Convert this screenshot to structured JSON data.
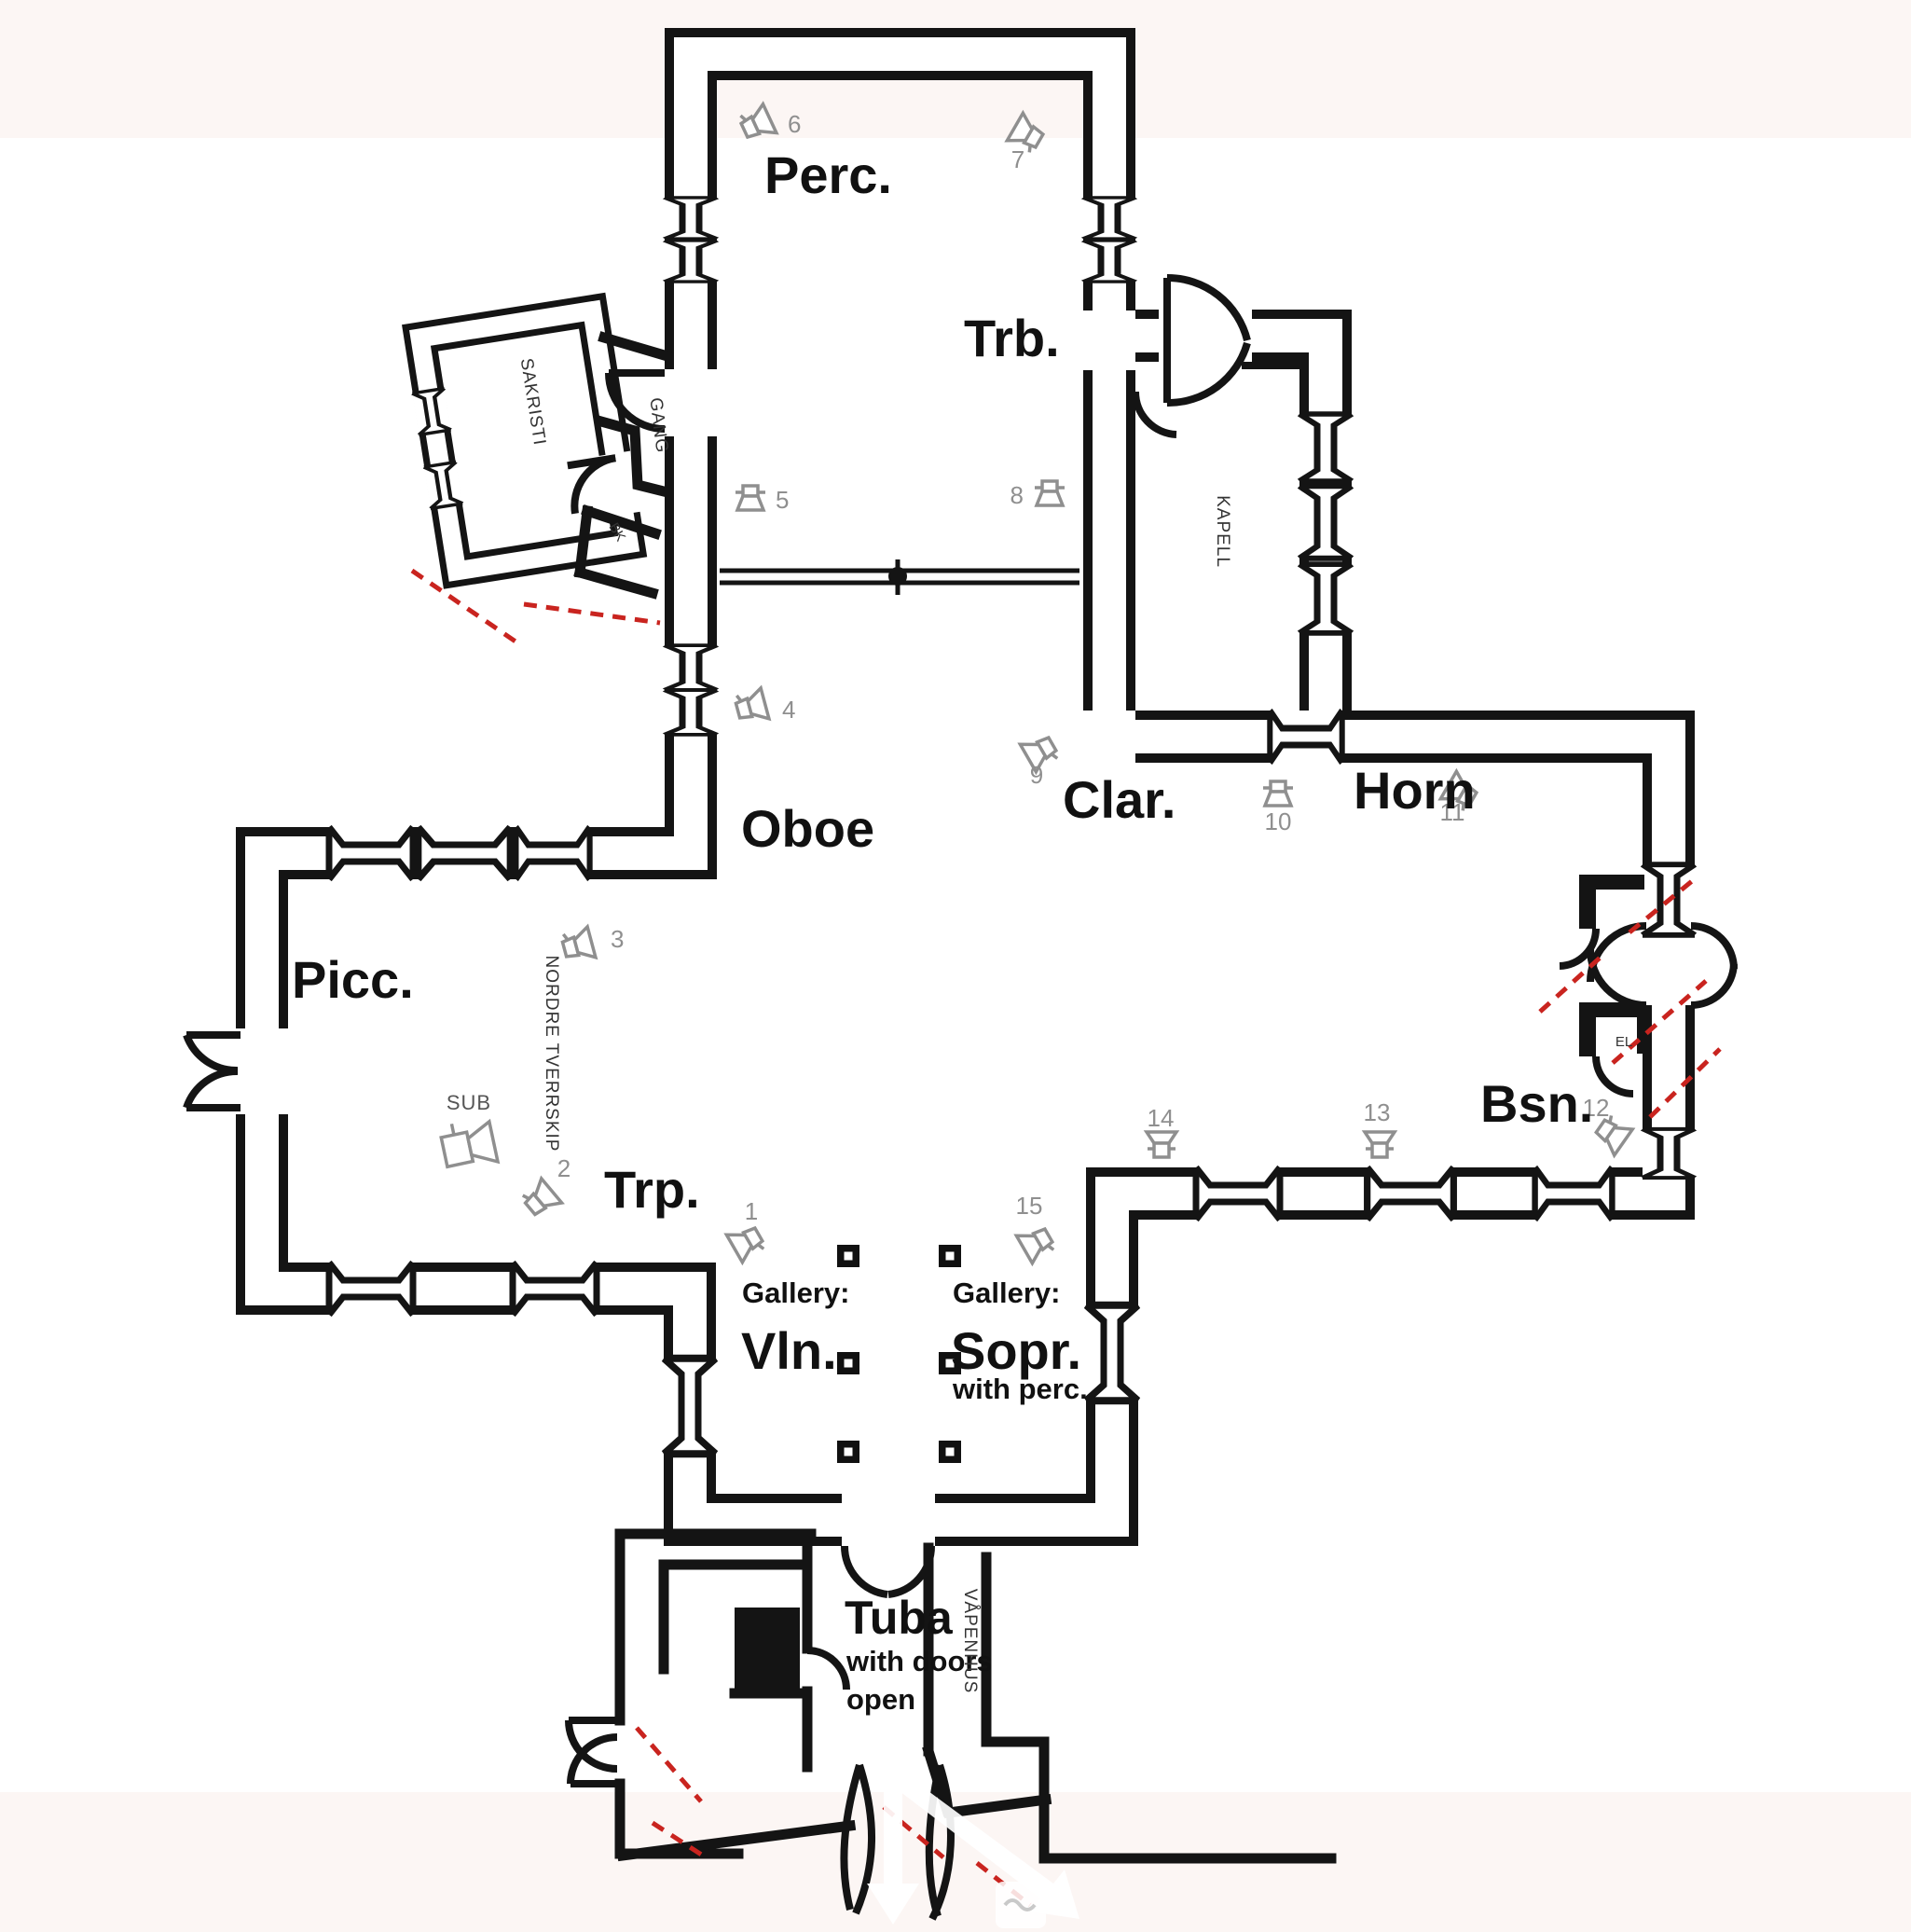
{
  "colors": {
    "background": "#ffffff",
    "page_band": "#fcf6f4",
    "wall": "#141414",
    "icon_gray": "#8f8f8f",
    "dash_red": "#c9241f"
  },
  "labels": {
    "perc": "Perc.",
    "trb": "Trb.",
    "oboe": "Oboe",
    "clar": "Clar.",
    "horn": "Horn",
    "picc": "Picc.",
    "trp": "Trp.",
    "bsn": "Bsn.",
    "vln": "Vln.",
    "sopr": "Sopr.",
    "tuba": "Tuba",
    "gallery_left": "Gallery:",
    "gallery_right": "Gallery:",
    "with_perc": "with perc.",
    "with_doors": "with doors",
    "open": "open"
  },
  "rooms": {
    "sakristi": "SAKRISTI",
    "gang": "GANG",
    "bk": "BK",
    "kapell": "KAPELL",
    "nordre_tverrskip": "NORDRE TVERRSKIP",
    "vapenhus": "VÅPENHUS",
    "el": "EL"
  },
  "speakers": {
    "sub_label": "SUB",
    "n1": "1",
    "n2": "2",
    "n3": "3",
    "n4": "4",
    "n5": "5",
    "n6": "6",
    "n7": "7",
    "n8": "8",
    "n9": "9",
    "n10": "10",
    "n11": "11",
    "n12": "12",
    "n13": "13",
    "n14": "14",
    "n15": "15"
  }
}
